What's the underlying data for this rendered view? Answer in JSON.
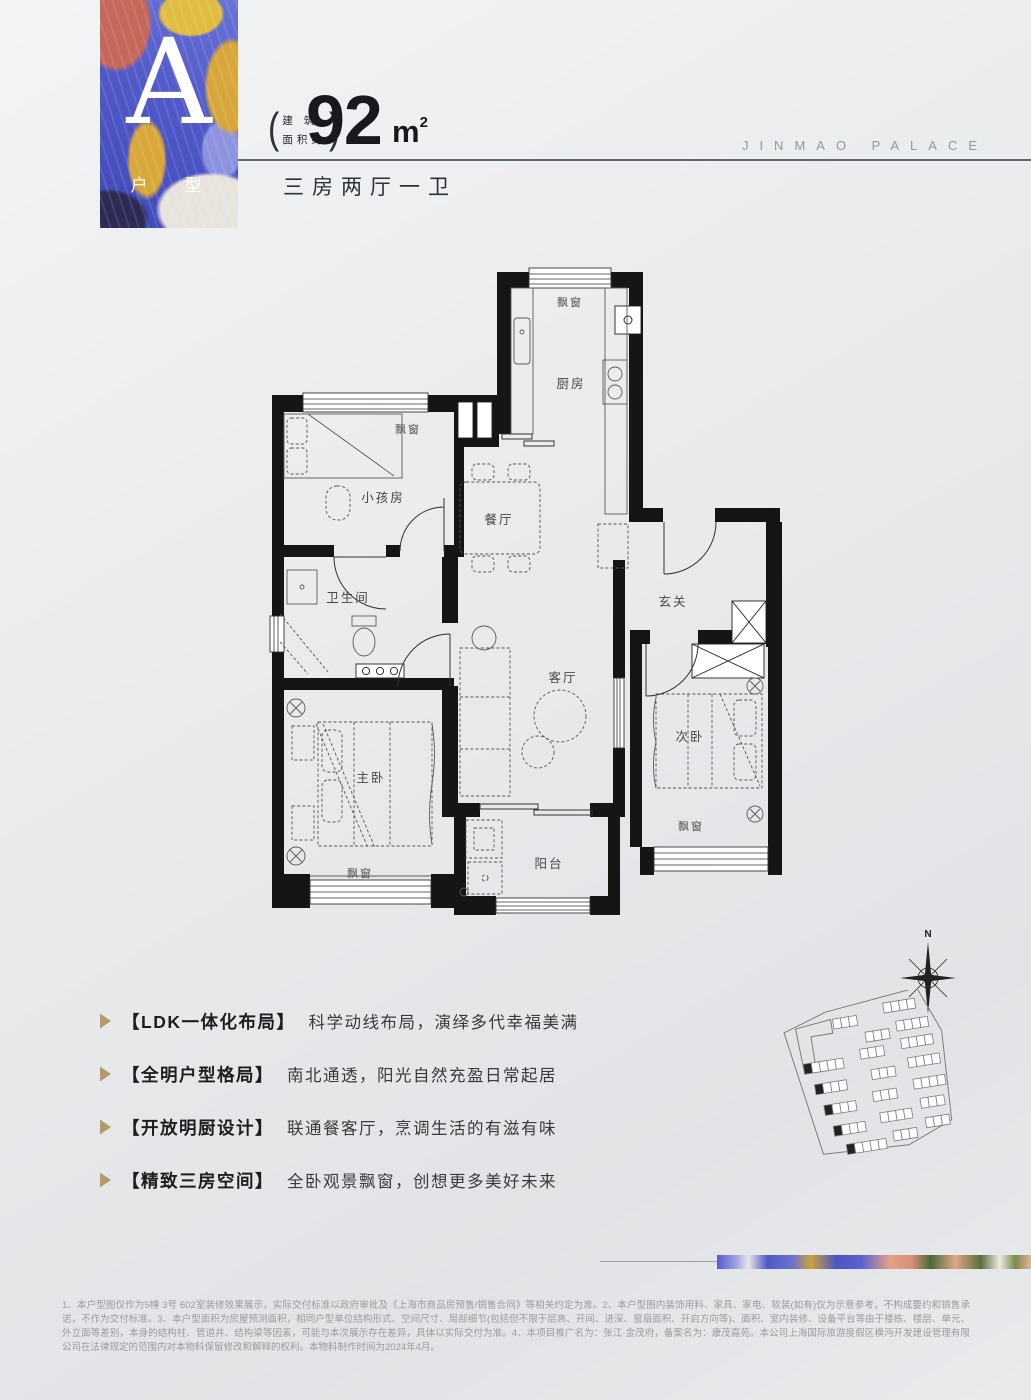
{
  "header": {
    "unit_letter": "A",
    "unit_label": "户 型",
    "area_note_line1": "建 筑",
    "area_note_line2": "面积约",
    "paren_left": "(",
    "paren_right": ")",
    "area_value": "92",
    "area_unit": "m",
    "area_unit_sup": "2",
    "layout_summary": "三房两厅一卫",
    "brand": "JINMAO PALACE"
  },
  "colors": {
    "accent_gold": "#b59a6b",
    "rule": "#5a6d72",
    "card_blue": "#5159c9",
    "card_coral": "#c4685a"
  },
  "floorplan": {
    "rooms": {
      "kitchen": "厨房",
      "dining": "餐厅",
      "living": "客厅",
      "kids": "小孩房",
      "bath": "卫生间",
      "foyer": "玄关",
      "master": "主卧",
      "second": "次卧",
      "balcony": "阳台",
      "bay_kitchen": "飘窗",
      "bay_kids": "飘窗",
      "bay_master": "飘窗",
      "bay_second": "飘窗"
    }
  },
  "features": [
    {
      "tag": "【LDK一体化布局】",
      "desc": "科学动线布局，演绎多代幸福美满"
    },
    {
      "tag": "【全明户型格局】",
      "desc": "南北通透，阳光自然充盈日常起居"
    },
    {
      "tag": "【开放明厨设计】",
      "desc": "联通餐客厅，烹调生活的有滋有味"
    },
    {
      "tag": "【精致三房空间】",
      "desc": "全卧观景飘窗，创想更多美好未来"
    }
  ],
  "compass": {
    "north": "N"
  },
  "disclaimer": "1、本户型图仅作为5幢 3号 602室装修效果展示，实际交付标准以政府审批及《上海市商品房预售/销售合同》等相关约定为准。2、本户型图内装饰用料、家具、家电、软装(如有)仅为示意参考，不构成要约和销售承诺，不作为交付标准。3、本户型面积为房屋预测面积，相同户型单位结构形式、空间尺寸、局部细节(包括但不限于层高、开间、进深、窗扇面积、开启方向等)、面积、室内装修、设备平台等由于楼栋、楼层、单元、外立面等差别，本身的结构柱、管道井、结构梁等因素，可能与本次展示存在差异，具体以实际交付为准。4、本项目推广名为：张江·金茂府，备案名为：康茂嘉苑。本公司上海国际旅游度假区横沔开发建设管理有限公司在法律规定的范围内对本物料保留修改和解释的权利。本物料制作时间为2024年4月。"
}
